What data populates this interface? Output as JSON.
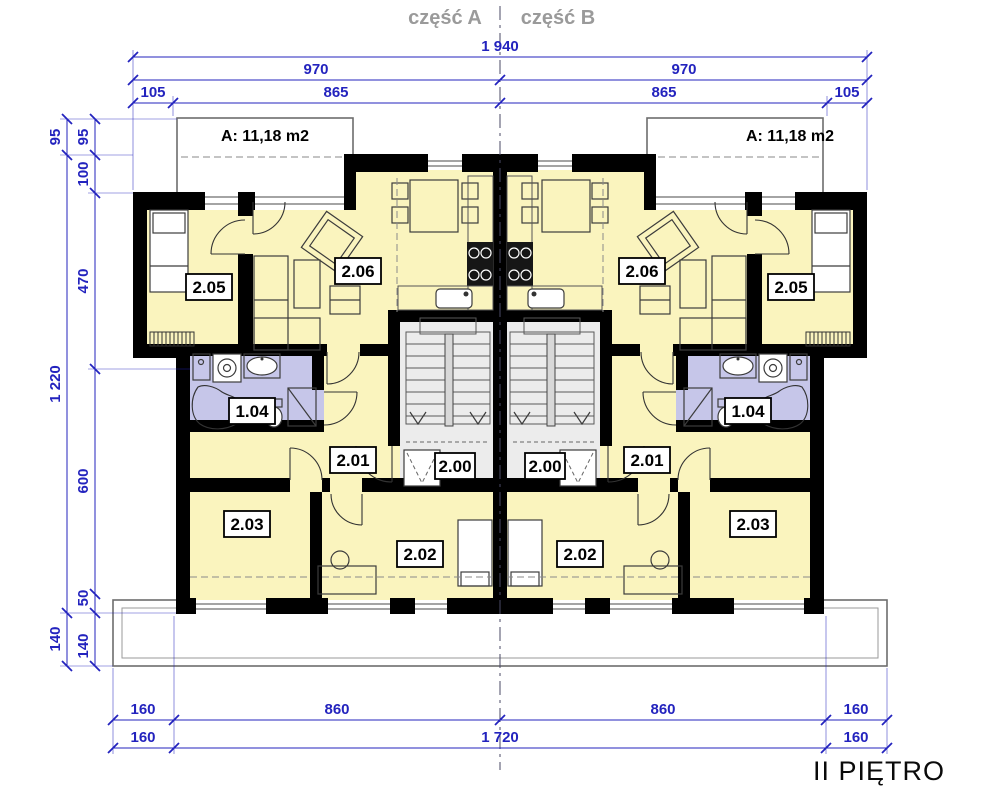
{
  "header": {
    "part_a": "część A",
    "part_b": "część B"
  },
  "floor_label": "II PIĘTRO",
  "area_labels": {
    "left": "A: 11,18 m2",
    "right": "A: 11,18 m2"
  },
  "room_labels": {
    "left": {
      "bedroom": "2.05",
      "living": "2.06",
      "bathroom": "1.04",
      "hall": "2.01",
      "staircase": "2.00",
      "room_a": "2.03",
      "room_b": "2.02"
    },
    "right": {
      "bedroom": "2.05",
      "living": "2.06",
      "bathroom": "1.04",
      "hall": "2.01",
      "staircase": "2.00",
      "room_a": "2.03",
      "room_b": "2.02"
    }
  },
  "dimensions": {
    "top": [
      "1 940",
      "970",
      "970",
      "105",
      "865",
      "865",
      "105"
    ],
    "left_outer": [
      "95",
      "1 220",
      "140"
    ],
    "left_inner": [
      "95",
      "100",
      "470",
      "600",
      "50",
      "140"
    ],
    "bottom_upper": [
      "160",
      "860",
      "860",
      "160"
    ],
    "bottom_lower": [
      "160",
      "1 720",
      "160"
    ]
  },
  "colors": {
    "floor": "#FAF4BE",
    "bathroom": "#C6C6E9",
    "staircase": "#ECECEC",
    "dimension_blue": "#2323BE",
    "header_gray": "#9A9A9A",
    "wall_black": "#000000"
  }
}
